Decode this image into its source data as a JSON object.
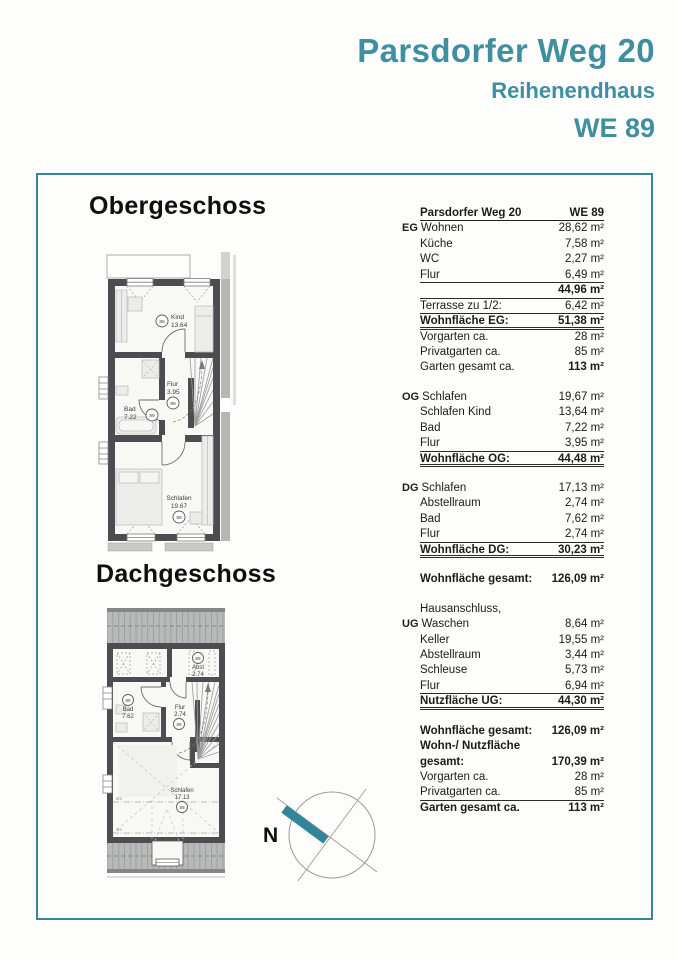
{
  "header": {
    "title": "Parsdorfer Weg 20",
    "subtitle": "Reihenendhaus",
    "unit": "WE 89"
  },
  "colors": {
    "accent": "#3f8fa0",
    "wall": "#4c4c51"
  },
  "plans": {
    "og": {
      "title": "Obergeschoss",
      "rooms": [
        {
          "name": "Kind",
          "area": "13.64",
          "badge": "89"
        },
        {
          "name": "Flur",
          "area": "3.95",
          "badge": "89"
        },
        {
          "name": "Bad",
          "area": "7.22",
          "badge": "89"
        },
        {
          "name": "Schlafen",
          "area": "19.67",
          "badge": "89"
        }
      ]
    },
    "dg": {
      "title": "Dachgeschoss",
      "rooms": [
        {
          "name": "Abst",
          "area": "2.74",
          "badge": "89"
        },
        {
          "name": "Bad",
          "area": "7.62",
          "badge": "89"
        },
        {
          "name": "Flur",
          "area": "2.74",
          "badge": "89"
        },
        {
          "name": "Schlafen",
          "area": "17.13",
          "badge": "89"
        }
      ],
      "dims": [
        "2m",
        "1m"
      ]
    }
  },
  "compass": {
    "north_label": "N"
  },
  "table": {
    "header": {
      "name": "Parsdorfer Weg 20",
      "unit": "WE 89"
    },
    "rows": [
      {
        "prefix": "EG",
        "label": "Wohnen",
        "value": "28,62 m²"
      },
      {
        "label": "Küche",
        "value": "7,58 m²"
      },
      {
        "label": "WC",
        "value": "2,27 m²"
      },
      {
        "label": "Flur",
        "value": "6,49 m²",
        "underline": "u1"
      },
      {
        "label": "",
        "value": "44,96 m²",
        "value_bold": true,
        "underline": "u1"
      },
      {
        "label": "Terrasse zu 1/2:",
        "value": "6,42 m²",
        "underline": "u1"
      },
      {
        "label": "Wohnfläche EG:",
        "value": "51,38 m²",
        "bold": true,
        "underline": "u2"
      },
      {
        "label": "Vorgarten ca.",
        "value": "28 m²"
      },
      {
        "label": "Privatgarten ca.",
        "value": "85 m²"
      },
      {
        "label": "Garten gesamt ca.",
        "value": "113 m²",
        "value_bold": true
      },
      {
        "prefix": "OG",
        "label": "Schlafen",
        "value": "19,67 m²",
        "gap": true
      },
      {
        "label": "Schlafen Kind",
        "value": "13,64 m²"
      },
      {
        "label": "Bad",
        "value": "7,22 m²"
      },
      {
        "label": "Flur",
        "value": "3,95 m²",
        "underline": "u1"
      },
      {
        "label": "Wohnfläche OG:",
        "value": "44,48 m²",
        "bold": true,
        "underline": "u2"
      },
      {
        "prefix": "DG",
        "label": "Schlafen",
        "value": "17,13 m²",
        "gap": true
      },
      {
        "label": "Abstellraum",
        "value": "2,74 m²"
      },
      {
        "label": "Bad",
        "value": "7,62 m²"
      },
      {
        "label": "Flur",
        "value": "2,74 m²",
        "underline": "u1"
      },
      {
        "label": "Wohnfläche DG:",
        "value": "30,23 m²",
        "bold": true,
        "underline": "u2"
      },
      {
        "label": "Wohnfläche gesamt:",
        "value": "126,09 m²",
        "bold": true,
        "gap": true
      },
      {
        "label": "Hausanschluss,",
        "value": "",
        "gap": true
      },
      {
        "prefix": "UG",
        "label": "Waschen",
        "value": "8,64 m²"
      },
      {
        "label": "Keller",
        "value": "19,55 m²"
      },
      {
        "label": "Abstellraum",
        "value": "3,44 m²"
      },
      {
        "label": "Schleuse",
        "value": "5,73 m²"
      },
      {
        "label": "Flur",
        "value": "6,94 m²",
        "underline": "u1"
      },
      {
        "label": "Nutzfläche UG:",
        "value": "44,30 m²",
        "bold": true,
        "underline": "u2"
      },
      {
        "label": "Wohnfläche gesamt:",
        "value": "126,09 m²",
        "bold": true,
        "gap": true
      },
      {
        "label": "Wohn-/ Nutzfläche",
        "value": "",
        "bold": true
      },
      {
        "label": "gesamt:",
        "value": "170,39 m²",
        "bold": true
      },
      {
        "label": "Vorgarten ca.",
        "value": "28 m²"
      },
      {
        "label": "Privatgarten ca.",
        "value": "85 m²",
        "underline": "u1"
      },
      {
        "label": "Garten gesamt ca.",
        "value": "113 m²",
        "bold": true
      }
    ]
  }
}
